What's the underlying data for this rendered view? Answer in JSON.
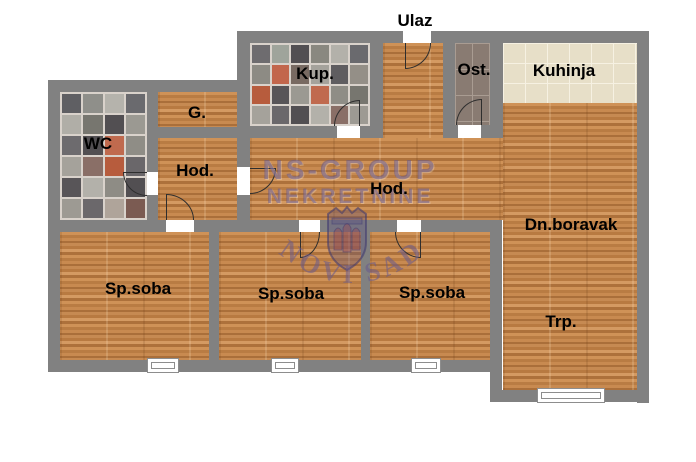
{
  "plan": {
    "entrance_label": "Ulaz",
    "rooms": {
      "wc": "WC",
      "garderoba": "G.",
      "hodnik_left": "Hod.",
      "hodnik_center": "Hod.",
      "kupatilo": "Kup.",
      "ostava": "Ost.",
      "kuhinja": "Kuhinja",
      "dnevni_boravak": "Dn.boravak",
      "trpezarija": "Trp.",
      "spavaca_soba_1": "Sp.soba",
      "spavaca_soba_2": "Sp.soba",
      "spavaca_soba_3": "Sp.soba"
    },
    "watermark": {
      "line1": "NS-GROUP",
      "line2": "NEKRETNINE",
      "badge_text": "NOVI SAD"
    },
    "colors": {
      "wall": "#818181",
      "wood_floor": "#c1854d",
      "kitchen_tile": "#e7dfc8",
      "storage_tile": "#897b72",
      "watermark": "#685a8c",
      "label_text": "#000000"
    }
  }
}
